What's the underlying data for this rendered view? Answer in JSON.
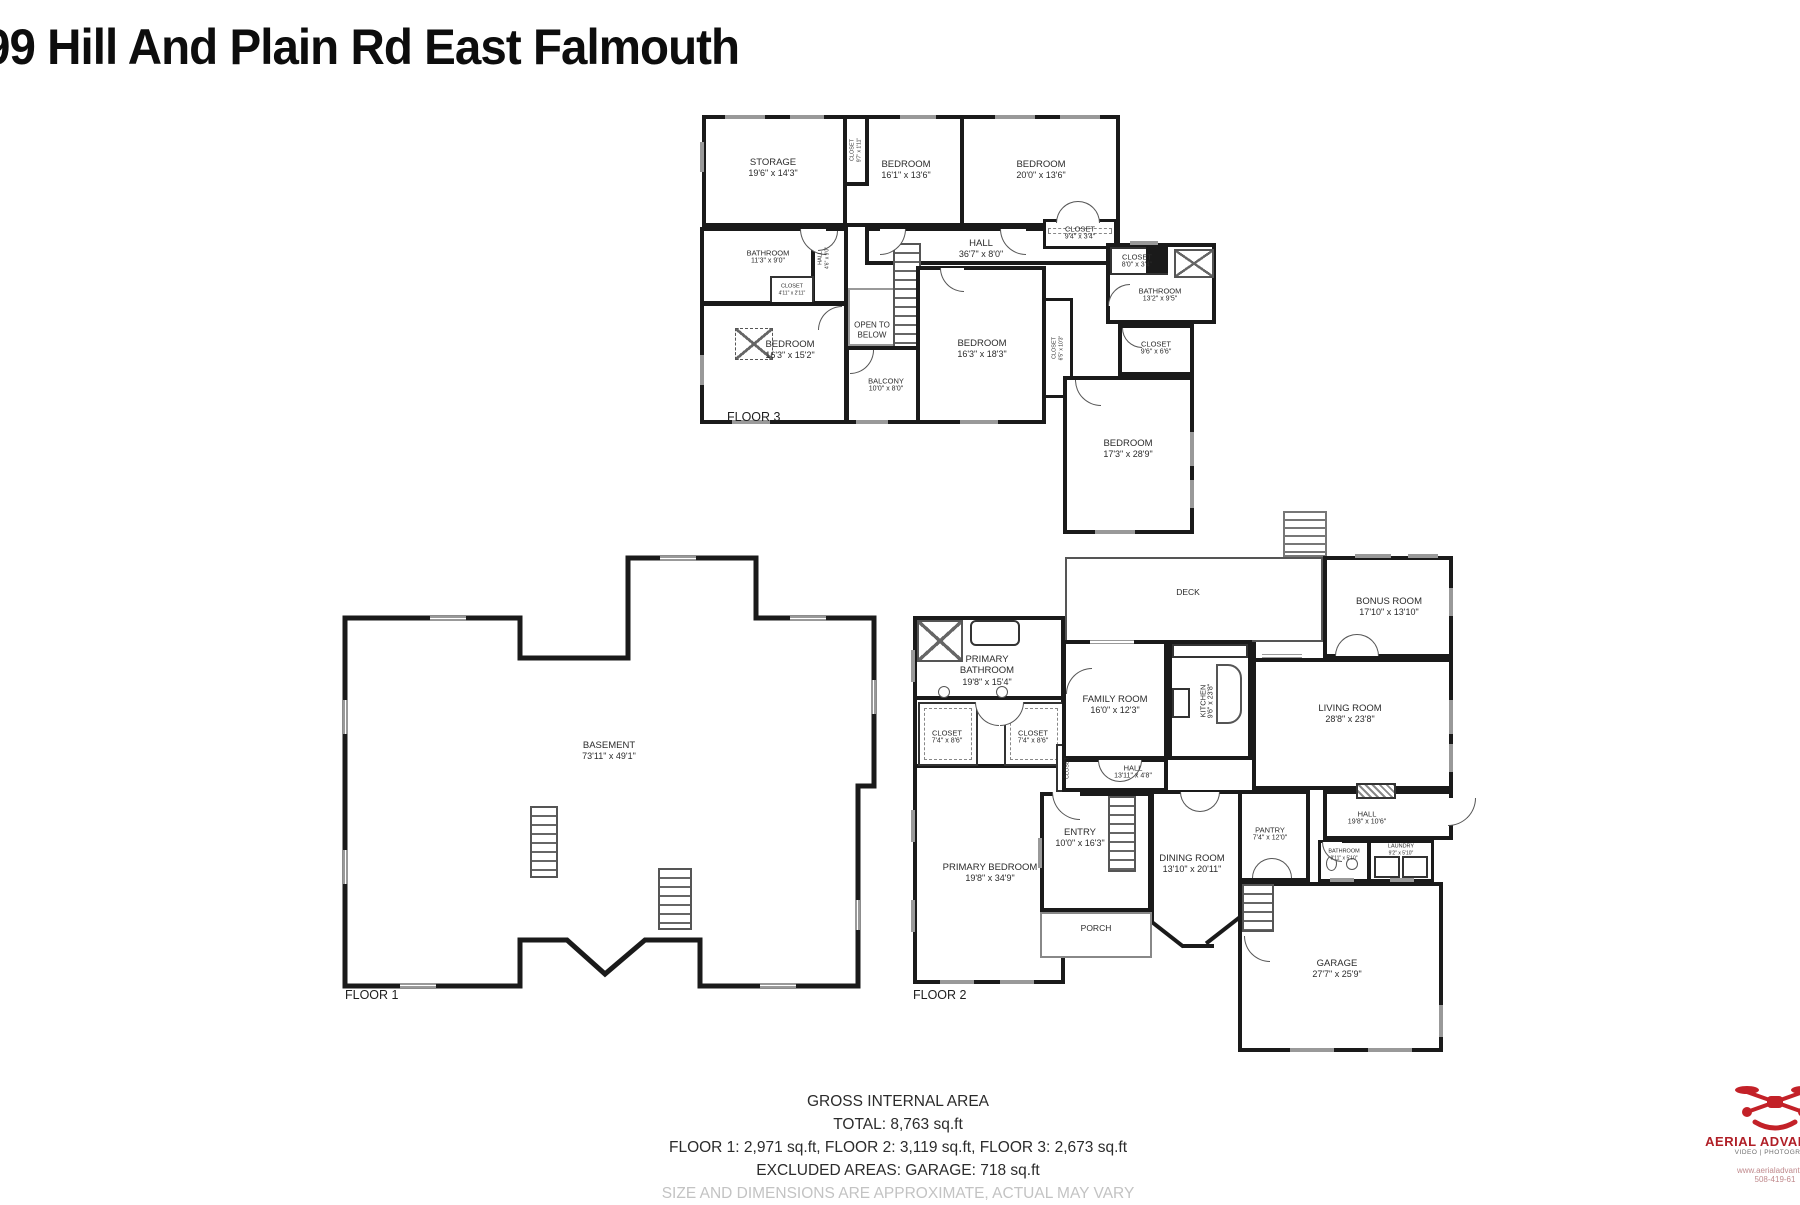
{
  "title": "99 Hill And Plain Rd East Falmouth",
  "floor3": {
    "label": "FLOOR 3",
    "rooms": {
      "storage": {
        "name": "STORAGE",
        "dims": "19'6\" x 14'3\""
      },
      "closet_strip": {
        "name": "CLOSET",
        "dims": "9'7\" x 1'11\""
      },
      "bedroom_a": {
        "name": "BEDROOM",
        "dims": "16'1\" x 13'6\""
      },
      "bedroom_b": {
        "name": "BEDROOM",
        "dims": "20'0\" x 13'6\""
      },
      "hall": {
        "name": "HALL",
        "dims": "36'7\" x 8'0\""
      },
      "closet_hall": {
        "name": "CLOSET",
        "dims": "9'4\" x 3'4\""
      },
      "bathroom_left": {
        "name": "BATHROOM",
        "dims": "11'3\" x 9'0\""
      },
      "closet_small": {
        "name": "CLOSET",
        "dims": "4'11\" x 2'11\""
      },
      "hall_small": {
        "name": "HALL",
        "dims": "4'6\" x 9'0\""
      },
      "bedroom_c": {
        "name": "BEDROOM",
        "dims": "16'3\" x 15'2\""
      },
      "open_below": {
        "name": "OPEN TO BELOW"
      },
      "balcony": {
        "name": "BALCONY",
        "dims": "10'0\" x 8'0\""
      },
      "bedroom_d": {
        "name": "BEDROOM",
        "dims": "16'3\" x 18'3\""
      },
      "closet_vert": {
        "name": "CLOSET",
        "dims": "6'5\" x 10'3\""
      },
      "closet_right": {
        "name": "CLOSET",
        "dims": "8'0\" x 3'4\""
      },
      "bathroom_right": {
        "name": "BATHROOM",
        "dims": "13'2\" x 9'5\""
      },
      "closet_br": {
        "name": "CLOSET",
        "dims": "9'6\" x 6'6\""
      },
      "bedroom_e": {
        "name": "BEDROOM",
        "dims": "17'3\" x 28'9\""
      }
    }
  },
  "floor1": {
    "label": "FLOOR 1",
    "rooms": {
      "basement": {
        "name": "BASEMENT",
        "dims": "73'11\" x 49'1\""
      }
    }
  },
  "floor2": {
    "label": "FLOOR 2",
    "rooms": {
      "primary_bathroom": {
        "name": "PRIMARY BATHROOM",
        "dims": "19'8\" x 15'4\""
      },
      "closet_l": {
        "name": "CLOSET",
        "dims": "7'4\" x 8'6\""
      },
      "closet_r": {
        "name": "CLOSET",
        "dims": "7'4\" x 8'6\""
      },
      "closet_tiny": {
        "name": "CLOSET"
      },
      "family": {
        "name": "FAMILY ROOM",
        "dims": "16'0\" x 12'3\""
      },
      "hall_small": {
        "name": "HALL",
        "dims": "13'11\" x 4'8\""
      },
      "deck": {
        "name": "DECK"
      },
      "bonus": {
        "name": "BONUS ROOM",
        "dims": "17'10\" x 13'10\""
      },
      "kitchen": {
        "name": "KITCHEN",
        "dims": "9'6\" x 23'8\""
      },
      "living": {
        "name": "LIVING ROOM",
        "dims": "28'8\" x 23'8\""
      },
      "entry": {
        "name": "ENTRY",
        "dims": "10'0\" x 16'3\""
      },
      "dining": {
        "name": "DINING ROOM",
        "dims": "13'10\" x 20'11\""
      },
      "pantry": {
        "name": "PANTRY",
        "dims": "7'4\" x 12'0\""
      },
      "porch": {
        "name": "PORCH"
      },
      "hall_right": {
        "name": "HALL",
        "dims": "19'8\" x 10'6\""
      },
      "bathroom": {
        "name": "BATHROOM",
        "dims": "8'11\" x 5'10\""
      },
      "laundry": {
        "name": "LAUNDRY",
        "dims": "9'2\" x 5'10\""
      },
      "garage": {
        "name": "GARAGE",
        "dims": "27'7\" x 25'9\""
      },
      "primary_bedroom": {
        "name": "PRIMARY BEDROOM",
        "dims": "19'8\" x 34'9\""
      }
    }
  },
  "summary": {
    "heading": "GROSS INTERNAL AREA",
    "total": "TOTAL: 8,763 sq.ft",
    "floors": "FLOOR 1: 2,971 sq.ft, FLOOR 2: 3,119 sq.ft, FLOOR 3: 2,673 sq.ft",
    "excluded": "EXCLUDED AREAS: GARAGE: 718 sq.ft",
    "disclaimer": "SIZE AND DIMENSIONS ARE APPROXIMATE, ACTUAL MAY VARY"
  },
  "branding": {
    "name": "AERIAL ADVANTAGE",
    "tagline": "VIDEO | PHOTOGRAPH",
    "web": "www.aerialadvantage",
    "phone": "508-419-61"
  }
}
